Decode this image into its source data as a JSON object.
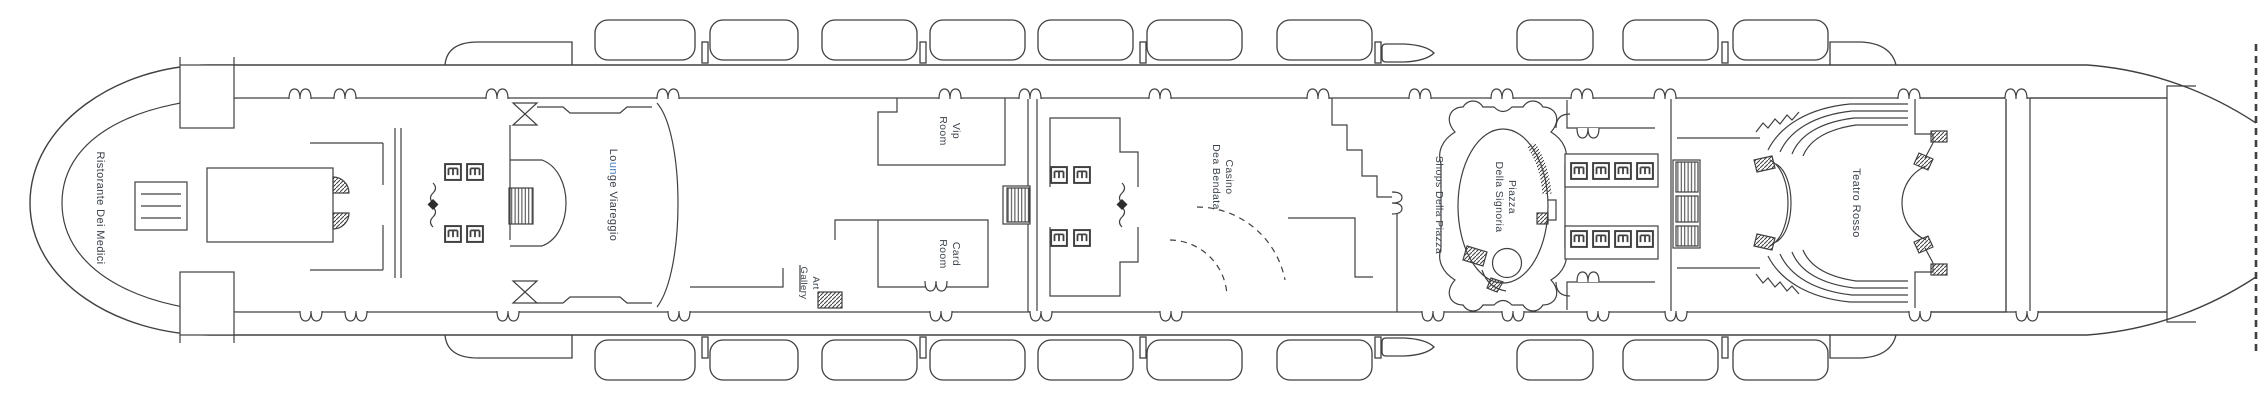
{
  "deck_plan": {
    "labels": {
      "ristorante": "Ristorante Dei Medici",
      "lounge": {
        "prefix": "Lo",
        "highlight": "un",
        "suffix": "ge Viareggio"
      },
      "vip_room": {
        "line1": "Vip",
        "line2": "Room"
      },
      "card_room": {
        "line1": "Card",
        "line2": "Room"
      },
      "art_gallery": {
        "line1": "Art",
        "line2": "Gallery"
      },
      "casino": {
        "line1": "Casino",
        "line2": "Dea Bendata"
      },
      "shops": "Shops Della Piazza",
      "piazza": {
        "line1": "Piazza",
        "line2": "Della Signoria"
      },
      "teatro": "Teatro Rosso"
    },
    "colors": {
      "line": "#404040",
      "label": "#3a4149",
      "highlight_letters": "#4a7fc1",
      "background": "#ffffff"
    },
    "icons": {
      "elevator": "elevator-icon",
      "stairs": "stairs-hatch-icon",
      "watertight_door": "watertight-door-diamond-icon",
      "door_notch": "door-notch-icon",
      "lifeboat": "lifeboat-icon",
      "tender": "tender-boat-icon"
    }
  }
}
